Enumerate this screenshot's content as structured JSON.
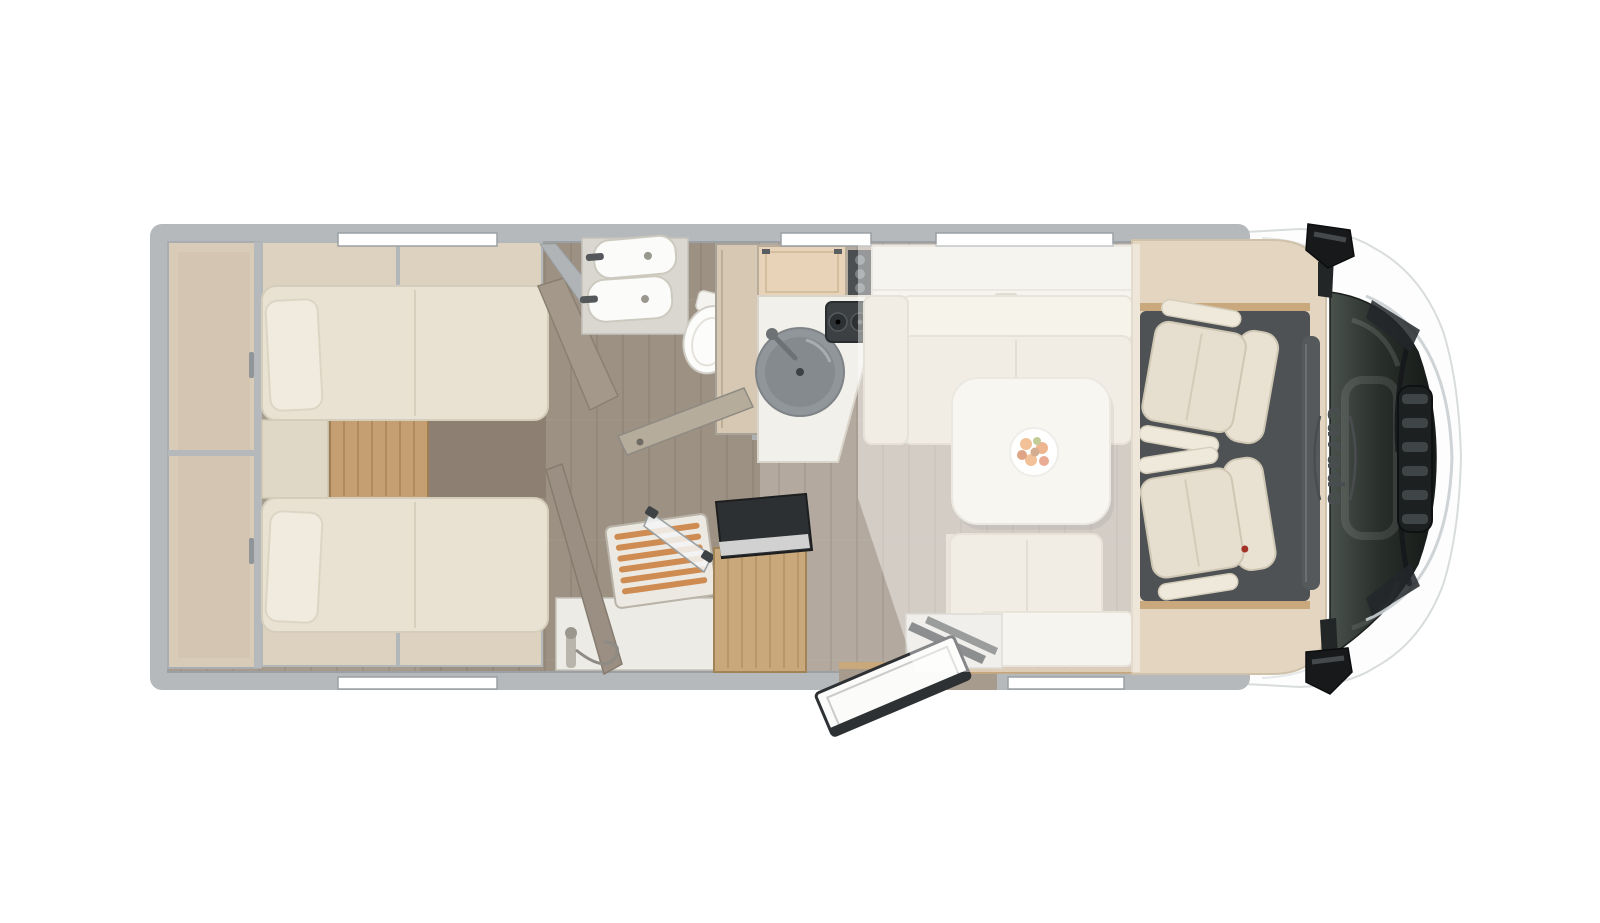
{
  "image": {
    "description": "Top-down 3D floor plan rendering of a Carado motorhome",
    "background": "#ffffff"
  },
  "vehicle": {
    "brand_logo": "carado",
    "sections": {
      "rear_bedroom": {
        "items": [
          "rear-wardrobe",
          "overhead-shelf-top",
          "overhead-shelf-bottom",
          "twin-bed-upper",
          "twin-bed-lower",
          "pillow-upper",
          "pillow-lower",
          "center-cushion",
          "wood-step",
          "foot-cabinet"
        ]
      },
      "bathroom": {
        "items": [
          "vanity-counter",
          "washbasin-upper",
          "washbasin-lower",
          "toilet",
          "tall-cabinet",
          "bathroom-door-open"
        ]
      },
      "shower": {
        "items": [
          "shower-partition-wall",
          "wood-slat-grate",
          "folding-glass-door",
          "hand-shower"
        ]
      },
      "galley": {
        "items": [
          "overhead-cabinet",
          "spice-rack",
          "countertop",
          "round-sink",
          "two-burner-hob",
          "socket-panel"
        ]
      },
      "dinette": {
        "items": [
          "overhead-locker",
          "bench-top",
          "bench-side",
          "dinette-table",
          "fruit-plate",
          "bench-bottom"
        ]
      },
      "entrance": {
        "items": [
          "entry-step",
          "entry-door-open",
          "top-loading-cabinet"
        ]
      },
      "cab": {
        "items": [
          "cab-floor-mat",
          "dashboard",
          "swivel-seat-front",
          "swivel-seat-rear"
        ]
      },
      "front_end": {
        "items": [
          "windshield",
          "wipers",
          "grille",
          "mirror-top",
          "mirror-bottom",
          "headlight-top",
          "headlight-bottom"
        ]
      }
    },
    "features": {
      "window_count": 5,
      "drop_down_bed_overlay": true
    }
  },
  "colors": {
    "background": "#ffffff",
    "wall": "#b5b9bc",
    "wall_edge": "#9aa0a3",
    "floor": "#a79b8e",
    "furniture_cream": "#e7e0d1",
    "furniture_light": "#f0ede4",
    "table": "#f2efe6",
    "wood_light": "#c9a87c",
    "wood_step": "#c59f72",
    "shower_slats": "#cf8c52",
    "taupe_partition": "#9c9184",
    "cab_surround": "#e3d5c0",
    "cab_floor": "#4e5254",
    "seat_cream": "#e6dfd0",
    "fixture_white": "#fbfbfa",
    "windshield": "#242927",
    "mirror_black": "#1c1e1f",
    "logo_gray": "#4a4d4f",
    "fruit_orange": "#e8954f",
    "overlay_white": "rgba(255,255,255,0.42)"
  }
}
